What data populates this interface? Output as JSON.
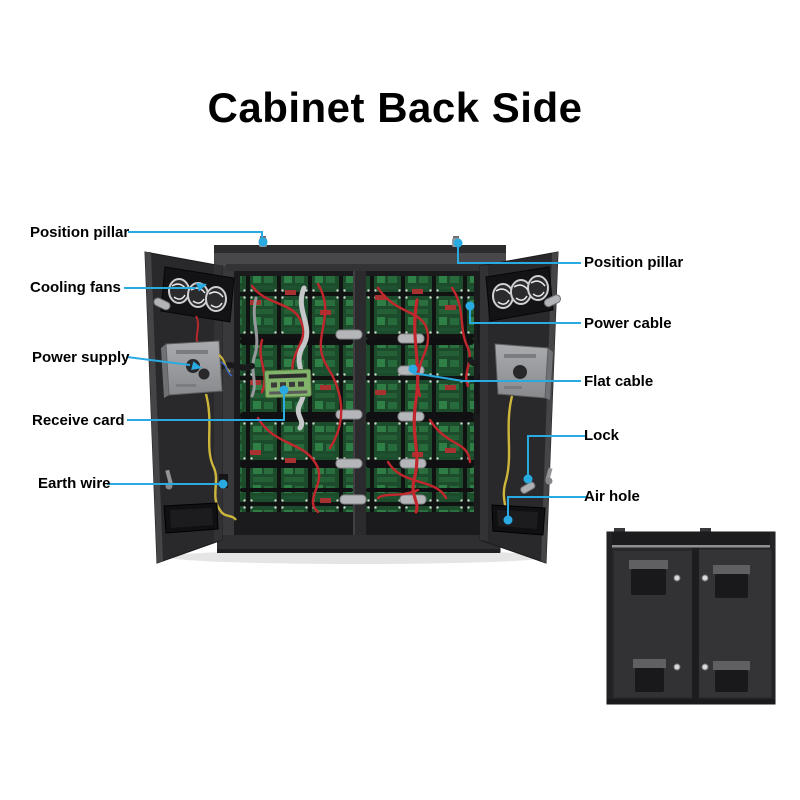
{
  "page": {
    "title": "Cabinet Back Side"
  },
  "annotations": {
    "left": [
      {
        "label": "Position pillar"
      },
      {
        "label": "Cooling fans"
      },
      {
        "label": "Power supply"
      },
      {
        "label": "Receive card"
      },
      {
        "label": "Earth wire"
      }
    ],
    "right": [
      {
        "label": "Position pillar"
      },
      {
        "label": "Power cable"
      },
      {
        "label": "Flat cable"
      },
      {
        "label": "Lock"
      },
      {
        "label": "Air hole"
      }
    ]
  },
  "colors": {
    "background": "#ffffff",
    "title_text": "#000000",
    "label_text": "#000000",
    "leader_line": "#29abe2",
    "cabinet_dark": "#2a2a2d",
    "pcb_green": "#2f7d44",
    "wire_red": "#c1272d",
    "wire_yellow": "#cdb63c",
    "metal_silver": "#b3b4b7"
  }
}
